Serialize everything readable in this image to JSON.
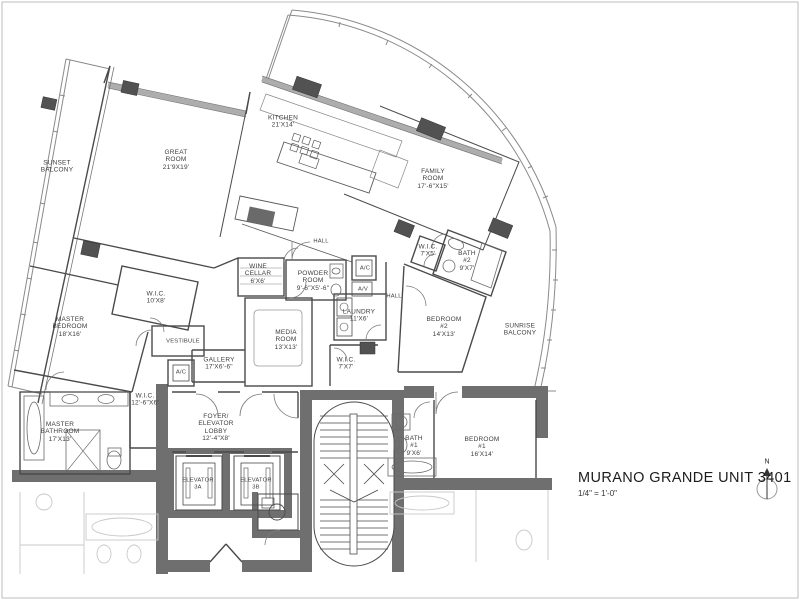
{
  "title": {
    "text": "MURANO GRANDE UNIT 3401",
    "scale": "1/4\" = 1'-0\"",
    "north_label": "N"
  },
  "rooms": {
    "sunset_balcony": "SUNSET\nBALCONY",
    "great_room": "GREAT\nROOM\n21'9X19'",
    "kitchen": "KITCHEN\n21'X14'",
    "family_room": "FAMILY\nROOM\n17'-6\"X15'",
    "master_bedroom": "MASTER\nBEDROOM\n18'X16'",
    "wic_master": "W.I.C.\n10'X8'",
    "vestibule": "VESTIBULE",
    "ac_1": "A/C",
    "gallery": "GALLERY\n17'X6'-6\"",
    "wine_cellar": "WINE\nCELLAR\n6'X6'",
    "powder_room": "POWDER\nROOM\n9'-6\"X5'-6\"",
    "hall_upper": "HALL",
    "ac_2": "A/C",
    "av": "A/V",
    "hall_lower": "HALL",
    "laundry": "LAUNDRY\n11'X6'",
    "media_room": "MEDIA\nROOM\n13'X13'",
    "wic_7x7": "W.I.C.\n7'X7'",
    "wic_7x5": "W.I.C.\n7'X5'",
    "bath_2": "BATH\n#2\n9'X7'",
    "bedroom_2": "BEDROOM\n#2\n14'X13'",
    "sunrise_balcony": "SUNRISE\nBALCONY",
    "master_bathroom": "MASTER\nBATHROOM\n17'X13'",
    "wic_12": "W.I.C.\n12'-6\"X6'",
    "foyer": "FOYER/\nELEVATOR\nLOBBY\n12'-4\"X8'",
    "elevator_a": "ELEVATOR\n3A",
    "elevator_b": "ELEVATOR\n3B",
    "bath_1": "BATH\n#1\n9'X6'",
    "bedroom_1": "BEDROOM\n#1\n16'X14'"
  },
  "colors": {
    "wall": "#4a4a4a",
    "core_wall": "#6f6f6f",
    "column": "#525252",
    "glass_band": "#adadad",
    "balcony_line": "#8a8a8a",
    "faint_fixture": "#c8c8c8",
    "background": "#ffffff"
  }
}
